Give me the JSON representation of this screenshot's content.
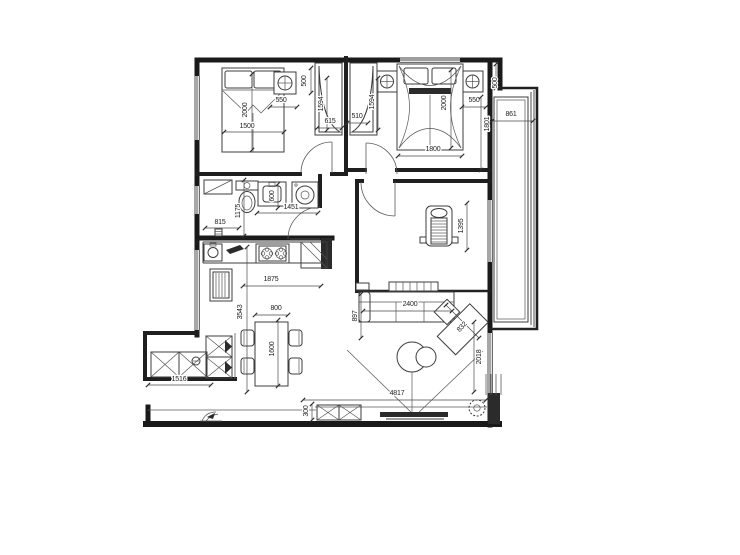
{
  "meta": {
    "type": "apartment-floor-plan",
    "canvas": {
      "width": 740,
      "height": 555
    },
    "colors": {
      "background": "#ffffff",
      "wall": "#1a1a1a",
      "line": "#555555",
      "dim_text": "#1d1d1d"
    }
  },
  "icons": {
    "bed-icon": "double bed with pillows",
    "canopy-bed-icon": "master bed with drapes",
    "wardrobe-icon": "closet with curved door",
    "ac-unit-icon": "square with crosshair circle",
    "toilet-icon": "toilet with tank",
    "vanity-sink-icon": "washbasin counter",
    "washing-machine-icon": "square with drum circle",
    "kitchen-sink-icon": "sink with round bowl",
    "stove-icon": "two burner cooktop",
    "corner-cabinet-icon": "cabinet with diagonal",
    "refrigerator-icon": "fridge with coil lines",
    "dining-table-icon": "table with four chairs",
    "armchair-icon": "lounge chair",
    "desk-icon": "low console",
    "sofa-icon": "sectional sofa",
    "chaise-icon": "angled chaise module",
    "coffee-table-icon": "two round tables",
    "tv-icon": "flat tv with stand",
    "tv-cabinet-icon": "crossed storage boxes",
    "fan-icon": "hatched circle",
    "plant-icon": "small plant sketch",
    "floor-drain-icon": "small drain"
  },
  "dim_labels": [
    {
      "text": "2000",
      "x": 245,
      "y": 110,
      "rot": -90,
      "line": [
        252,
        74,
        252,
        150
      ]
    },
    {
      "text": "1500",
      "x": 247,
      "y": 126,
      "rot": 0,
      "line": [
        224,
        132,
        284,
        132
      ]
    },
    {
      "text": "550",
      "x": 281,
      "y": 100,
      "rot": 0,
      "line": [
        270,
        107,
        297,
        107
      ]
    },
    {
      "text": "500",
      "x": 304,
      "y": 81,
      "rot": -90,
      "line": [
        311,
        68,
        311,
        93
      ]
    },
    {
      "text": "1594",
      "x": 321,
      "y": 104,
      "rot": -90,
      "line": [
        327,
        78,
        327,
        130
      ]
    },
    {
      "text": "615",
      "x": 330,
      "y": 121,
      "rot": 0,
      "line": [
        317,
        128,
        342,
        128
      ]
    },
    {
      "text": "510",
      "x": 357,
      "y": 116,
      "rot": 0,
      "line": [
        347,
        123,
        368,
        123
      ]
    },
    {
      "text": "1594",
      "x": 372,
      "y": 102,
      "rot": -90,
      "line": [
        378,
        78,
        378,
        130
      ]
    },
    {
      "text": "2000",
      "x": 444,
      "y": 103,
      "rot": -90,
      "line": [
        451,
        70,
        451,
        148
      ]
    },
    {
      "text": "1800",
      "x": 433,
      "y": 149,
      "rot": 0,
      "line": [
        398,
        156,
        462,
        156
      ]
    },
    {
      "text": "550",
      "x": 474,
      "y": 100,
      "rot": 0,
      "line": [
        462,
        107,
        486,
        107
      ]
    },
    {
      "text": "1801",
      "x": 487,
      "y": 124,
      "rot": -90,
      "line": [
        481,
        97,
        481,
        170
      ]
    },
    {
      "text": "500",
      "x": 495,
      "y": 83,
      "rot": -90,
      "line": [
        496,
        64,
        496,
        88
      ]
    },
    {
      "text": "861",
      "x": 511,
      "y": 114,
      "rot": 0,
      "line": [
        492,
        121,
        533,
        121
      ]
    },
    {
      "text": "815",
      "x": 220,
      "y": 222,
      "rot": 0,
      "line": [
        205,
        228,
        239,
        228
      ]
    },
    {
      "text": "1175",
      "x": 238,
      "y": 211,
      "rot": -90,
      "line": [
        244,
        180,
        244,
        236
      ]
    },
    {
      "text": "600",
      "x": 272,
      "y": 196,
      "rot": -90,
      "line": [
        278,
        184,
        278,
        208
      ]
    },
    {
      "text": "1451",
      "x": 291,
      "y": 207,
      "rot": 0,
      "line": [
        257,
        213,
        318,
        213
      ]
    },
    {
      "text": "1875",
      "x": 271,
      "y": 279,
      "rot": 0,
      "line": [
        243,
        286,
        321,
        286
      ]
    },
    {
      "text": "3543",
      "x": 240,
      "y": 312,
      "rot": -90,
      "line": [
        247,
        247,
        247,
        392
      ]
    },
    {
      "text": "800",
      "x": 276,
      "y": 308,
      "rot": 0,
      "line": [
        255,
        315,
        288,
        315
      ]
    },
    {
      "text": "1600",
      "x": 272,
      "y": 349,
      "rot": -90,
      "line": [
        278,
        320,
        278,
        386
      ]
    },
    {
      "text": "1516",
      "x": 179,
      "y": 379,
      "rot": 0,
      "line": [
        148,
        385,
        211,
        385
      ]
    },
    {
      "text": "1395",
      "x": 461,
      "y": 226,
      "rot": -90,
      "line": [
        467,
        203,
        467,
        250
      ]
    },
    {
      "text": "897",
      "x": 355,
      "y": 316,
      "rot": -90,
      "line": [
        361,
        294,
        361,
        338
      ]
    },
    {
      "text": "2400",
      "x": 410,
      "y": 304,
      "rot": 0,
      "line": [
        363,
        311,
        452,
        311
      ]
    },
    {
      "text": "832",
      "x": 462,
      "y": 327,
      "rot": -47,
      "line": [
        446,
        305,
        479,
        338
      ]
    },
    {
      "text": "2018",
      "x": 479,
      "y": 357,
      "rot": -90,
      "line": [
        474,
        322,
        474,
        392
      ]
    },
    {
      "text": "4817",
      "x": 397,
      "y": 393,
      "rot": 0,
      "line": [
        303,
        400,
        486,
        400
      ]
    },
    {
      "text": "300",
      "x": 306,
      "y": 411,
      "rot": -90,
      "line": [
        312,
        404,
        312,
        420
      ]
    }
  ]
}
